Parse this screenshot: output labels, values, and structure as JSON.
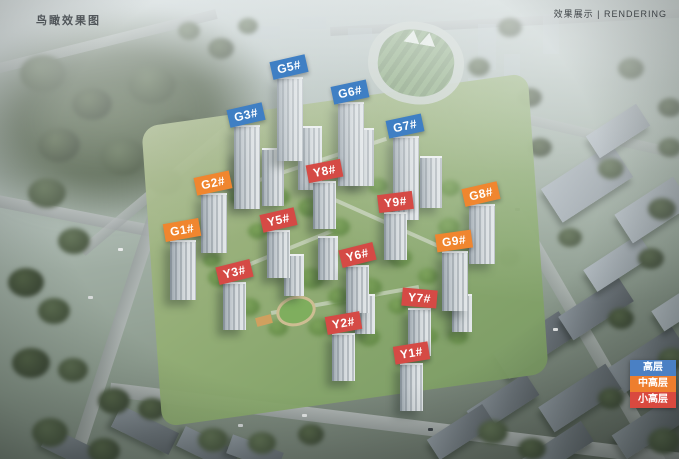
{
  "header": {
    "top_left_caption": "鸟瞰效果图",
    "top_right_caption": "效果展示 | RENDERING"
  },
  "legend": {
    "items": [
      {
        "label": "高层",
        "type": "high",
        "color": "#4a80c4"
      },
      {
        "label": "中高层",
        "type": "mid_high",
        "color": "#ee7e2e"
      },
      {
        "label": "小高层",
        "type": "small_high",
        "color": "#d9493f"
      }
    ]
  },
  "label_colors": {
    "high": "#3f7fc4",
    "mid_high": "#f0862f",
    "small_high": "#d54a45"
  },
  "building_labels": [
    {
      "text": "G5#",
      "type": "high",
      "x": 271,
      "y": 58,
      "rot": -13
    },
    {
      "text": "G6#",
      "type": "high",
      "x": 332,
      "y": 83,
      "rot": -12
    },
    {
      "text": "G3#",
      "type": "high",
      "x": 228,
      "y": 106,
      "rot": -13
    },
    {
      "text": "G7#",
      "type": "high",
      "x": 387,
      "y": 117,
      "rot": -12
    },
    {
      "text": "G2#",
      "type": "mid_high",
      "x": 195,
      "y": 174,
      "rot": -12
    },
    {
      "text": "Y8#",
      "type": "small_high",
      "x": 307,
      "y": 162,
      "rot": -11
    },
    {
      "text": "Y9#",
      "type": "small_high",
      "x": 378,
      "y": 193,
      "rot": -7
    },
    {
      "text": "G8#",
      "type": "mid_high",
      "x": 463,
      "y": 185,
      "rot": -13
    },
    {
      "text": "Y5#",
      "type": "small_high",
      "x": 261,
      "y": 211,
      "rot": -13
    },
    {
      "text": "G1#",
      "type": "mid_high",
      "x": 164,
      "y": 221,
      "rot": -10
    },
    {
      "text": "G9#",
      "type": "mid_high",
      "x": 436,
      "y": 232,
      "rot": -8
    },
    {
      "text": "Y6#",
      "type": "small_high",
      "x": 340,
      "y": 246,
      "rot": -14
    },
    {
      "text": "Y3#",
      "type": "small_high",
      "x": 217,
      "y": 263,
      "rot": -14
    },
    {
      "text": "Y7#",
      "type": "small_high",
      "x": 402,
      "y": 289,
      "rot": 5
    },
    {
      "text": "Y2#",
      "type": "small_high",
      "x": 326,
      "y": 314,
      "rot": -10
    },
    {
      "text": "Y1#",
      "type": "small_high",
      "x": 394,
      "y": 344,
      "rot": -9
    }
  ]
}
